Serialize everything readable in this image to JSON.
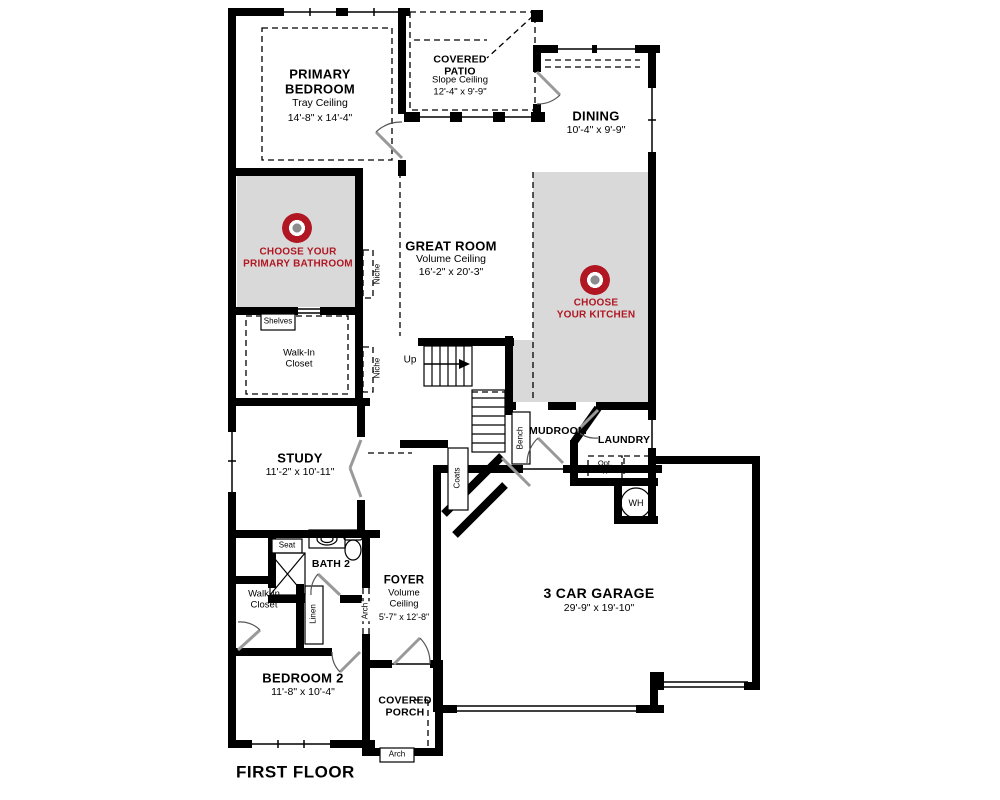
{
  "title": "FIRST FLOOR",
  "colors": {
    "accent": "#b01722",
    "zone_fill": "#d9d9d9",
    "wall": "#000000"
  },
  "rooms": {
    "primary_bedroom": {
      "name": "PRIMARY BEDROOM",
      "ceiling": "Tray Ceiling",
      "dims": "14'-8\" x 14'-4\""
    },
    "covered_patio": {
      "name": "COVERED PATIO",
      "ceiling": "Slope Ceiling",
      "dims": "12'-4\" x 9'-9\""
    },
    "dining": {
      "name": "DINING",
      "dims": "10'-4\" x 9'-9\""
    },
    "great_room": {
      "name": "GREAT ROOM",
      "ceiling": "Volume Ceiling",
      "dims": "16'-2\" x 20'-3\""
    },
    "study": {
      "name": "STUDY",
      "dims": "11'-2\" x 10'-11\""
    },
    "foyer": {
      "name": "FOYER",
      "ceiling": "Volume Ceiling",
      "dims": "5'-7\" x 12'-8\""
    },
    "bedroom_2": {
      "name": "BEDROOM 2",
      "dims": "11'-8\" x 10'-4\""
    },
    "garage": {
      "name": "3 CAR GARAGE",
      "dims": "29'-9\" x 19'-10\""
    },
    "covered_porch": {
      "name": "COVERED PORCH"
    },
    "mudroom": {
      "name": "MUDROOM"
    },
    "laundry": {
      "name": "LAUNDRY"
    },
    "bath_2": {
      "name": "BATH 2"
    }
  },
  "hotspots": {
    "primary_bathroom": {
      "line1": "CHOOSE YOUR",
      "line2": "PRIMARY BATHROOM"
    },
    "kitchen": {
      "line1": "CHOOSE",
      "line2": "YOUR KITCHEN"
    }
  },
  "labels": {
    "walk_in_closet": "Walk-In Closet",
    "shelves": "Shelves",
    "niche": "Niche",
    "up": "Up",
    "bench": "Bench",
    "coats": "Coats",
    "seat": "Seat",
    "linen": "Linen",
    "arch": "Arch",
    "opt_w": "Opt. W",
    "opt_d": "Opt. D",
    "wh": "WH"
  }
}
